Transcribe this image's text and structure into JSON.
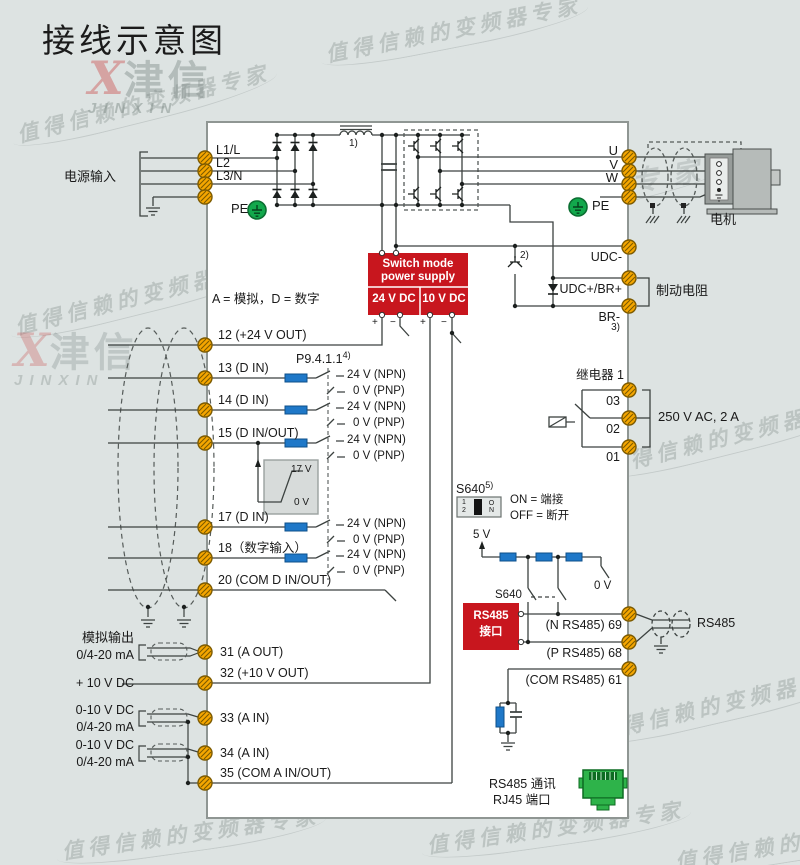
{
  "title": "接线示意图",
  "watermark": {
    "slogan": "值得信赖的变频器专家",
    "brand_x": "X",
    "brand_cn": "津信",
    "brand_en": "JINXIN"
  },
  "power_in": {
    "label": "电源输入",
    "t1": "L1/L",
    "t2": "L2",
    "t3": "L3/N",
    "pe": "PE"
  },
  "motor_out": {
    "u": "U",
    "v": "V",
    "w": "W",
    "pe": "PE",
    "motor": "电机"
  },
  "notes": {
    "n1": "1)",
    "n2": "2)",
    "n3": "3)",
    "n4": "4)",
    "n5": "5)"
  },
  "psu": {
    "name1": "Switch mode",
    "name2": "power supply",
    "v24": "24 V DC",
    "v10": "10 V DC",
    "plus": "+",
    "minus": "−"
  },
  "dc_link": {
    "udc_minus": "UDC-",
    "udc_plus": "UDC+/BR+",
    "br_minus": "BR-",
    "brake_res": "制动电阻"
  },
  "legend": "A = 模拟，D = 数字",
  "left_terms": {
    "t12": "12 (+24 V OUT)",
    "t13": "13 (D IN)",
    "t14": "14 (D IN)",
    "t15": "15 (D IN/OUT)",
    "t17": "17 (D IN)",
    "t18": "18（数字输入）",
    "t20": "20 (COM D IN/OUT)",
    "t31": "31 (A OUT)",
    "t32": "32 (+10 V OUT)",
    "t33": "33 (A IN)",
    "t34": "34 (A IN)",
    "t35": "35 (COM A IN/OUT)"
  },
  "dio": {
    "p9": "P9.4.1.1",
    "npn": "24 V (NPN)",
    "pnp": "0 V (PNP)",
    "th_hi": "17 V",
    "th_lo": "0 V"
  },
  "analog": {
    "aout1": "模拟输出",
    "aout2": "0/4-20 mA",
    "ref": "+ 10 V DC",
    "vin": "0-10 V DC",
    "iin": "0/4-20 mA"
  },
  "relay": {
    "title": "继电器 1",
    "c03": "03",
    "c02": "02",
    "c01": "01",
    "rating": "250 V AC, 2 A"
  },
  "s640": {
    "name": "S640",
    "d1": "1",
    "d2": "2",
    "on": "ON",
    "rule_on": "ON = 端接",
    "rule_off": "OFF = 断开",
    "v5": "5 V",
    "v0": "0 V"
  },
  "rs485": {
    "box1": "RS485",
    "box2": "接口",
    "n69": "(N RS485) 69",
    "p68": "(P RS485) 68",
    "com61": "(COM RS485) 61",
    "cable": "RS485",
    "com_line1": "RS485 通讯",
    "com_line2": "RJ45 端口"
  },
  "colors": {
    "accent_red": "#c8161e",
    "terminal_orange": "#f5a600",
    "pe_green": "#12a84c",
    "resistor_blue": "#1f78c8",
    "rj45_green": "#2eb34a"
  }
}
